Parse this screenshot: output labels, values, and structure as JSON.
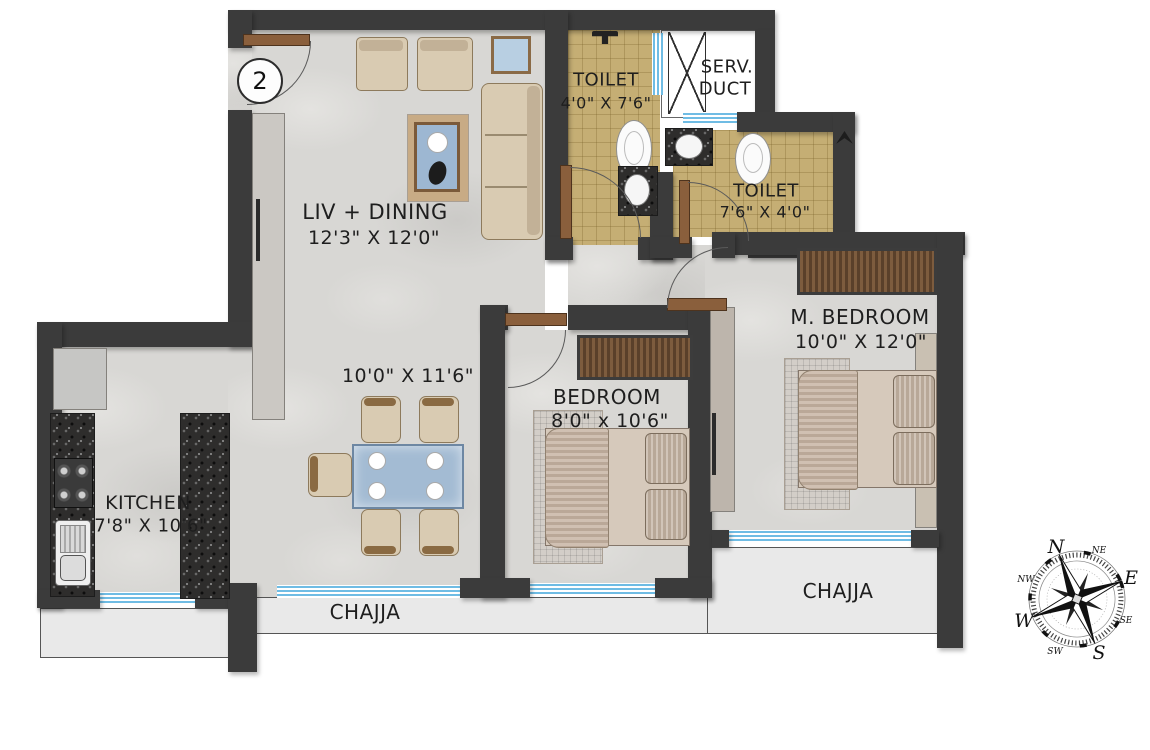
{
  "plan": {
    "entrance_badge": "2",
    "rooms": {
      "liv_dining": {
        "name": "LIV + DINING",
        "dims": "12'3\" X 12'0\""
      },
      "dining": {
        "dims": "10'0\" X 11'6\""
      },
      "toilet1": {
        "name": "TOILET",
        "dims": "4'0\" X 7'6\""
      },
      "serv_duct": {
        "line1": "SERV.",
        "line2": "DUCT"
      },
      "toilet2": {
        "name": "TOILET",
        "dims": "7'6\" X 4'0\""
      },
      "m_bedroom": {
        "name": "M. BEDROOM",
        "dims": "10'0\" X 12'0\""
      },
      "bedroom": {
        "name": "BEDROOM",
        "dims": "8'0\" x 10'6\""
      },
      "kitchen": {
        "name": "KITCHEN",
        "dims": "7'8\" X 10'6\""
      },
      "chajja_left": "CHAJJA",
      "chajja_right": "CHAJJA"
    },
    "compass": {
      "n": "N",
      "ne": "NE",
      "e": "E",
      "se": "SE",
      "s": "S",
      "sw": "SW",
      "w": "W",
      "nw": "NW"
    },
    "colors": {
      "wall": "#3b3b3b",
      "toilet_tile": "#c5ae74",
      "window_blue": "#6fbce4",
      "wood": "#8a5f3c",
      "marble_floor": "#d8d7d4",
      "chajja": "#e9e9e9"
    }
  }
}
